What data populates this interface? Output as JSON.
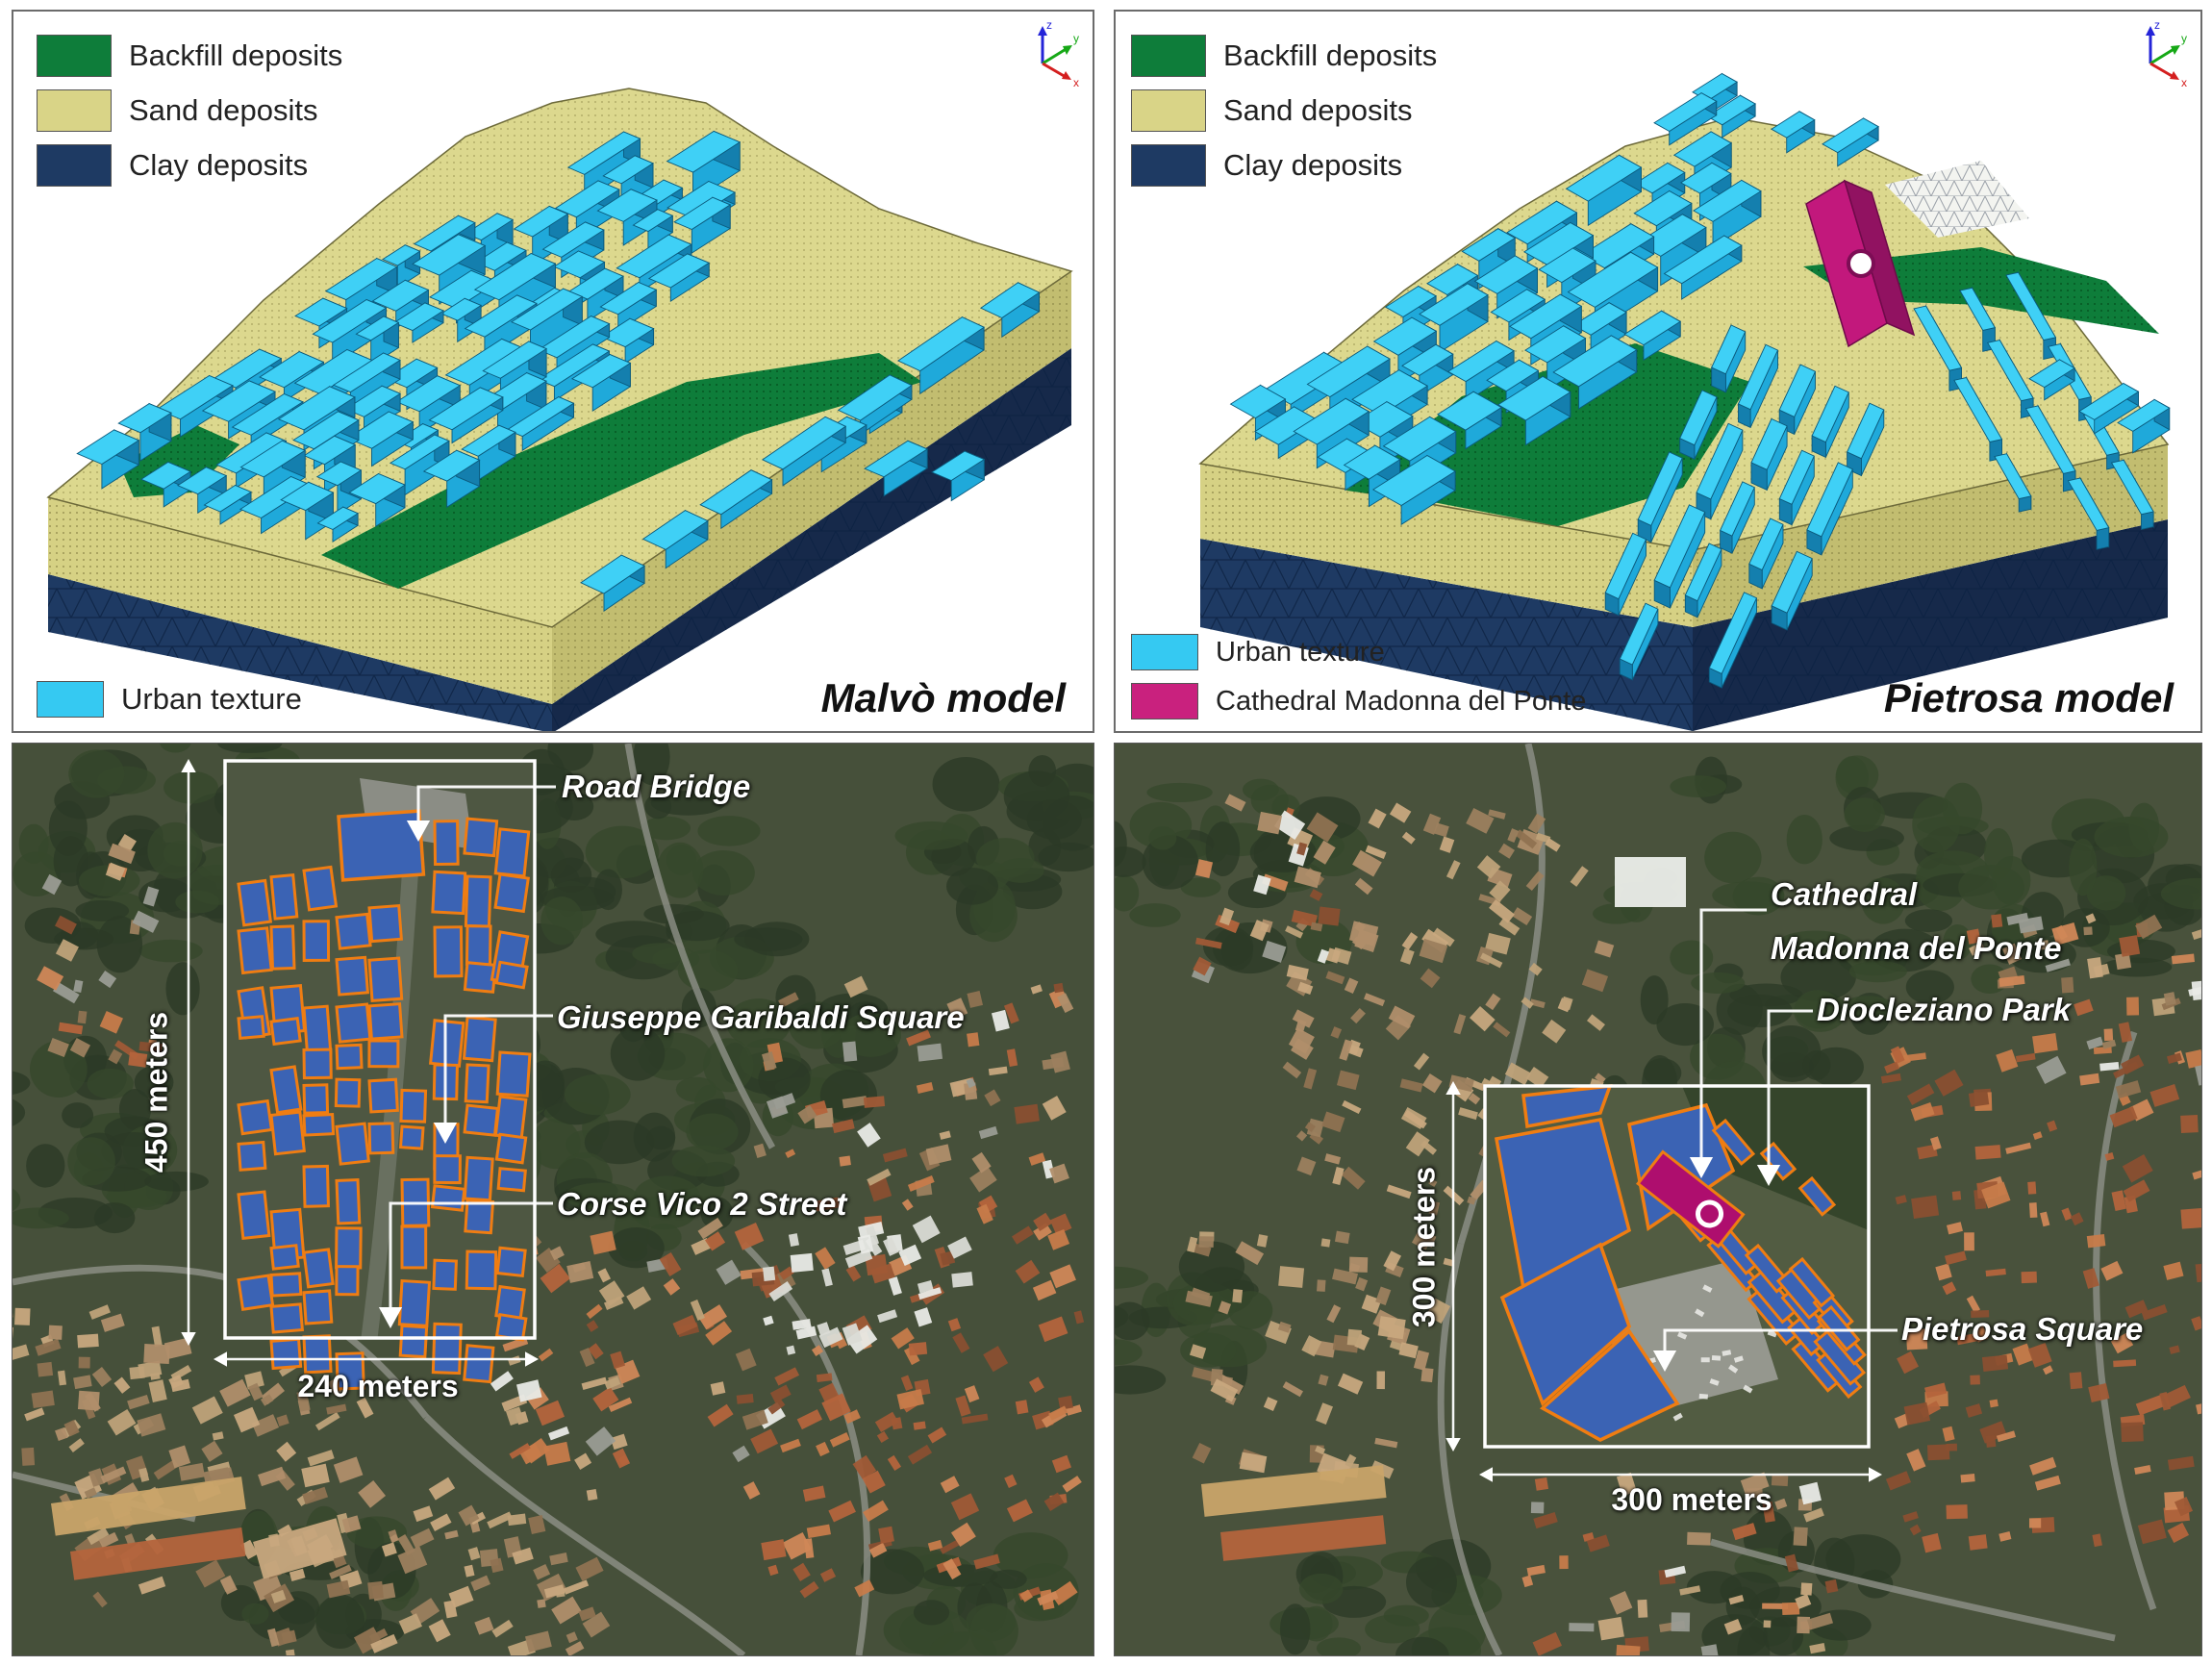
{
  "figure": {
    "description": "Two 3D FEM subsoil-and-urban-texture models with legends and two annotated satellite maps with building-footprint insets"
  },
  "colors": {
    "backfill": "#0e7d3a",
    "sand": "#d9d487",
    "clay": "#1e3a63",
    "urban": "#35c9f2",
    "cathedral": "#c9217e",
    "inset_building_fill": "#3b63b4",
    "inset_building_stroke": "#ef7d12",
    "annotation_text": "#ffffff"
  },
  "axis_triad": {
    "x": "x",
    "y": "y",
    "z": "z"
  },
  "panels": {
    "malvo": {
      "title": "Malvò model",
      "legend_top": [
        {
          "label": "Backfill deposits",
          "color": "#0e7d3a"
        },
        {
          "label": "Sand deposits",
          "color": "#d9d487"
        },
        {
          "label": "Clay deposits",
          "color": "#1e3a63"
        }
      ],
      "legend_bottom": [
        {
          "label": "Urban texture",
          "color": "#35c9f2"
        }
      ]
    },
    "pietrosa": {
      "title": "Pietrosa model",
      "legend_top": [
        {
          "label": "Backfill deposits",
          "color": "#0e7d3a"
        },
        {
          "label": "Sand deposits",
          "color": "#d9d487"
        },
        {
          "label": "Clay deposits",
          "color": "#1e3a63"
        }
      ],
      "legend_bottom": [
        {
          "label": "Urban texture",
          "color": "#35c9f2"
        },
        {
          "label": "Cathedral Madonna del Ponte",
          "color": "#c9217e"
        }
      ]
    },
    "map_left": {
      "annotations": {
        "road_bridge": {
          "label": "Road Bridge"
        },
        "garibaldi": {
          "label": "Giuseppe Garibaldi Square"
        },
        "corse_vico": {
          "label": "Corse Vico 2 Street"
        }
      },
      "scale_vertical": {
        "label": "450 meters"
      },
      "scale_horizontal": {
        "label": "240 meters"
      }
    },
    "map_right": {
      "annotations": {
        "cathedral": {
          "line1": "Cathedral",
          "line2": "Madonna del Ponte"
        },
        "diocleziano": {
          "label": "Diocleziano Park"
        },
        "pietrosa_square": {
          "label": "Pietrosa Square"
        }
      },
      "scale_vertical": {
        "label": "300 meters"
      },
      "scale_horizontal": {
        "label": "300 meters"
      }
    }
  }
}
